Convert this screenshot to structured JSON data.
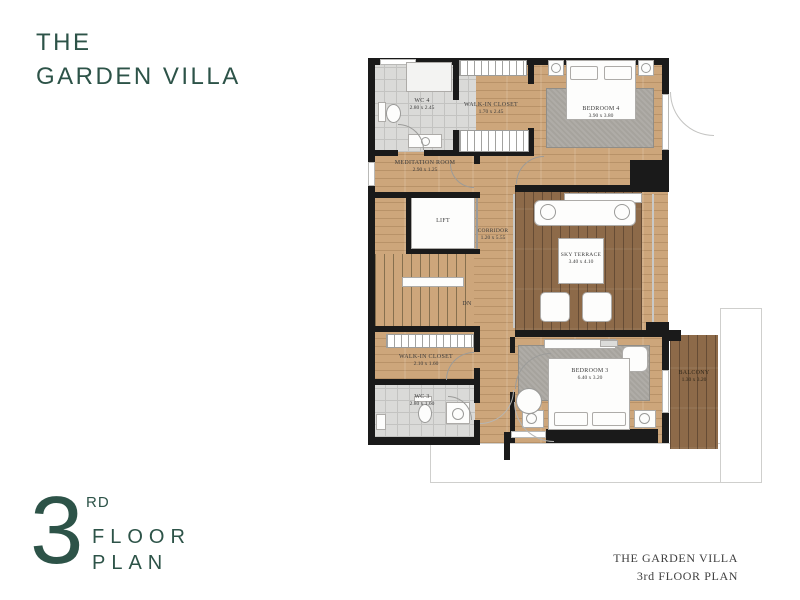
{
  "title": {
    "line1": "THE",
    "line2": "GARDEN VILLA"
  },
  "floor_badge": {
    "number": "3",
    "ordinal": "RD",
    "word1": "FLOOR",
    "word2": "PLAN"
  },
  "footer": {
    "line1": "THE GARDEN VILLA",
    "line2": "3rd FLOOR PLAN"
  },
  "colors": {
    "accent": "#2d5348",
    "wall": "#1a1a1a",
    "wood": "#cda67b",
    "deck": "#8d6a49",
    "tile": "#dadad8"
  },
  "rooms": {
    "wc4": {
      "name": "WC 4",
      "dims": "2.80 x 2.45"
    },
    "closet4": {
      "name": "WALK-IN CLOSET",
      "dims": "1.70 x 2.45"
    },
    "bedroom4": {
      "name": "BEDROOM 4",
      "dims": "3.90 x 3.80"
    },
    "meditation": {
      "name": "MEDITATION ROOM",
      "dims": "2.90 x 1.25"
    },
    "lift": {
      "name": "LIFT",
      "dims": ""
    },
    "corridor": {
      "name": "CORRIDOR",
      "dims": "1.20 x 5.55"
    },
    "terrace": {
      "name": "SKY TERRACE",
      "dims": "3.40 x 4.10"
    },
    "stairs": {
      "name": "DN",
      "dims": ""
    },
    "closet3": {
      "name": "WALK-IN CLOSET",
      "dims": "2.10 x 1.60"
    },
    "wc3": {
      "name": "WC 3",
      "dims": "2.80 x 1.60"
    },
    "bedroom3": {
      "name": "BEDROOM 3",
      "dims": "6.40 x 3.20"
    },
    "balcony": {
      "name": "BALCONY",
      "dims": "1.30 x 3.20"
    }
  }
}
